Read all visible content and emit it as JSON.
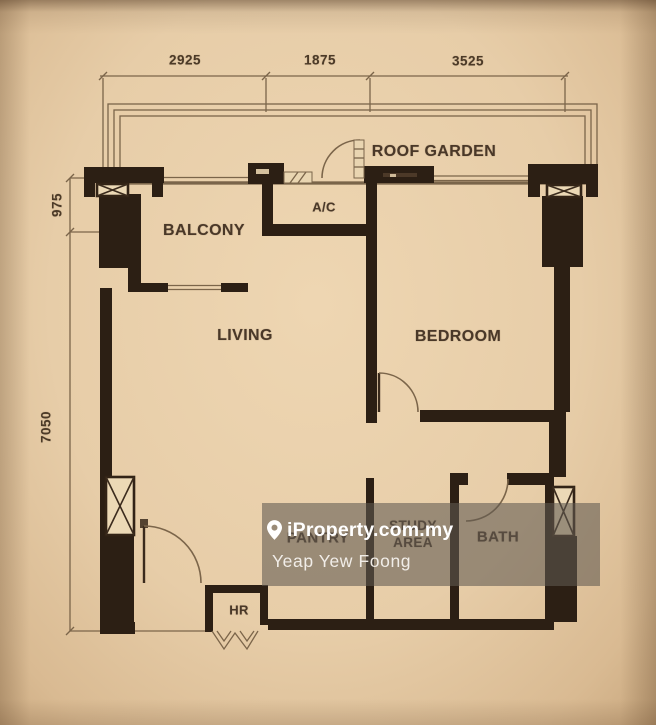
{
  "meta": {
    "description": "Apartment floor plan photo with agent watermark"
  },
  "colors": {
    "wall": "#2c1f14",
    "thin_line": "#7b654a",
    "label_ink": "#4a3828",
    "watermark_bg": "rgba(96,89,81,0.58)",
    "watermark_text": "#ffffff"
  },
  "dimensions": {
    "top": [
      {
        "label": "2925"
      },
      {
        "label": "1875"
      },
      {
        "label": "3525"
      }
    ],
    "left": [
      {
        "label": "975"
      },
      {
        "label": "7050"
      }
    ]
  },
  "rooms": {
    "roof_garden": "ROOF GARDEN",
    "balcony": "BALCONY",
    "ac": "A/C",
    "living": "LIVING",
    "bedroom": "BEDROOM",
    "pantry": "PANTRY",
    "study_area": "STUDY AREA",
    "bath": "BATH",
    "hr": "HR"
  },
  "watermark": {
    "brand": "iProperty.com.my",
    "agent": "Yeap Yew Foong",
    "icon": "location-pin-icon"
  }
}
